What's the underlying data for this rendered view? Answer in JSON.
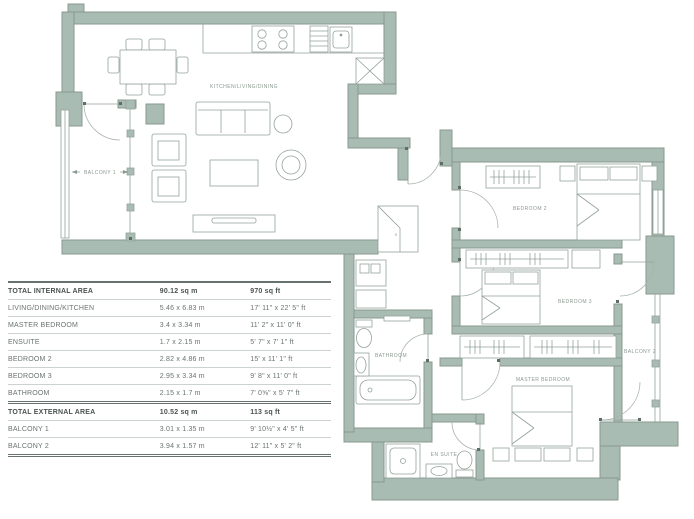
{
  "plan": {
    "labels": {
      "kitchen": "KITCHEN/LIVING/DINING",
      "balcony1": "BALCONY 1",
      "bedroom2": "BEDROOM 2",
      "bedroom3": "BEDROOM 3",
      "master": "MASTER BEDROOM",
      "bathroom": "BATHROOM",
      "ensuite": "EN SUITE",
      "balcony2": "BALCONY 2",
      "storage": "S"
    },
    "colors": {
      "wall": "#a9bcb4",
      "wall_edge": "#87988f",
      "furniture_line": "#94a29b",
      "door_arc": "#a8b4ae",
      "label_text": "#8b988f"
    }
  },
  "area_table": {
    "rows": [
      {
        "name": "TOTAL INTERNAL AREA",
        "metric": "90.12 sq m",
        "imperial": "970 sq ft"
      },
      {
        "name": "LIVING/DINING/KITCHEN",
        "metric": "5.46 x 6.83 m",
        "imperial": "17' 11\" x 22' 5\" ft"
      },
      {
        "name": "MASTER BEDROOM",
        "metric": "3.4 x 3.34 m",
        "imperial": "11' 2\" x 11' 0\" ft"
      },
      {
        "name": "ENSUITE",
        "metric": "1.7 x 2.15 m",
        "imperial": "5' 7\" x 7' 1\" ft"
      },
      {
        "name": "BEDROOM 2",
        "metric": "2.82 x 4.86 m",
        "imperial": "15' x 11' 1\" ft"
      },
      {
        "name": "BEDROOM 3",
        "metric": "2.95 x 3.34 m",
        "imperial": "9' 8\" x 11' 0\" ft"
      },
      {
        "name": "BATHROOM",
        "metric": "2.15 x 1.7 m",
        "imperial": "7' 0⅝\" x 5' 7\" ft"
      },
      {
        "name": "TOTAL EXTERNAL AREA",
        "metric": "10.52 sq m",
        "imperial": "113 sq ft"
      },
      {
        "name": "BALCONY 1",
        "metric": "3.01 x 1.35 m",
        "imperial": "9' 10½\" x 4' 5\" ft"
      },
      {
        "name": "BALCONY 2",
        "metric": "3.94 x 1.57 m",
        "imperial": "12' 11\" x 5' 2\" ft"
      }
    ]
  }
}
